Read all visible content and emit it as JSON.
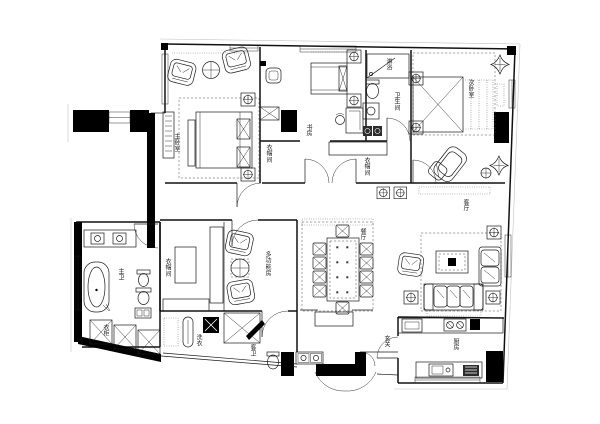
{
  "floor_plan": {
    "rooms": {
      "master_bedroom": "主卧室",
      "study": "书房",
      "study_closet": "衣帽间",
      "shower": "淋浴",
      "bathroom": "卫生间",
      "second_bedroom": "次卧室",
      "corridor_closet": "衣帽间",
      "walkin_closet": "衣帽间",
      "multifunction": "多功能房",
      "dining": "餐厅",
      "living": "客厅",
      "master_bath": "主卫",
      "wardrobe": "衣柜",
      "laundry": "洗衣",
      "guest_bath": "客卫",
      "foyer": "玄关",
      "kitchen": "厨房"
    },
    "colors": {
      "ink": "#1b1b1b",
      "wall": "#000000",
      "paper": "#ffffff"
    }
  }
}
